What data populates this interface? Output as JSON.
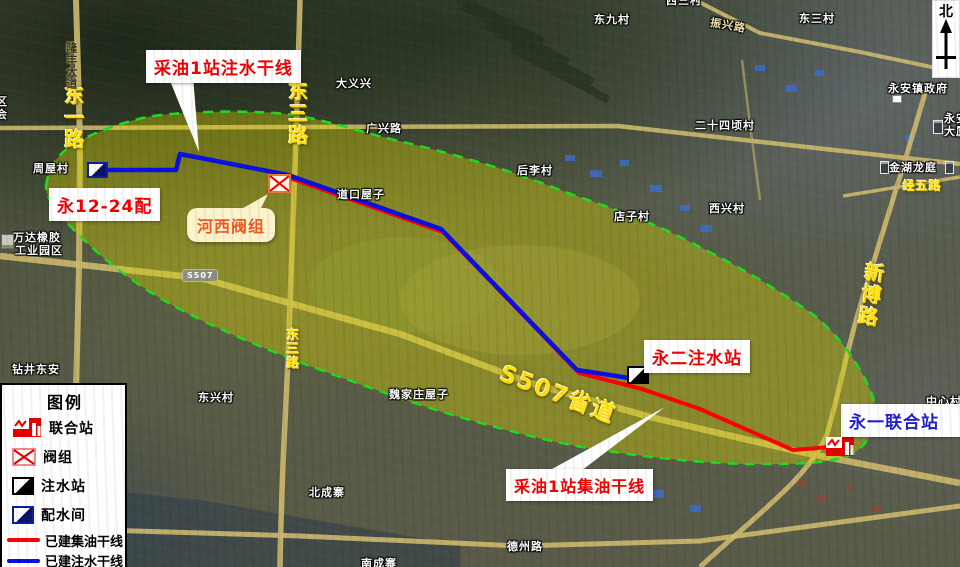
{
  "compass": {
    "north_label": "北"
  },
  "legend": {
    "title": "图例",
    "station_label": "联合站",
    "valve_label": "阀组",
    "injection_label": "注水站",
    "distribution_label": "配水间",
    "oil_line_label": "已建集油干线",
    "water_line_label": "已建注水干线"
  },
  "callouts": {
    "water_trunk": "采油1站注水干线",
    "oil_trunk": "采油1站集油干线",
    "valve_group": "河西阀组",
    "distribution_room": "永12-24配",
    "injection_station": "永二注水站",
    "union_station": "永一联合站"
  },
  "roads": {
    "dongyi": "东一路",
    "dongsan_upper": "东三路",
    "dongsan_lower": "东三路",
    "xinbo": "新博路",
    "s507_label": "S507省道",
    "s507_shield": "S507",
    "longfeng": "隆丰大道",
    "guangxing": "广兴路",
    "zhenxing": "振兴路",
    "jingwu": "经五路",
    "dezhou": "德州路"
  },
  "places": {
    "zhouwu": "周屋村",
    "wanda_line1": "万达橡胶",
    "wanda_line2": "工业园区",
    "zuanjing": "钻井东安",
    "dongxing": "东兴村",
    "dayixing": "大义兴",
    "dongjiu": "东九村",
    "dongsan_village": "东三村",
    "xisan_village": "西三村",
    "houli": "后李村",
    "ershisiqing": "二十四顷村",
    "xixing": "西兴村",
    "dianzi": "店子村",
    "daokou": "道口屋子",
    "weijiazhuang": "魏家庄屋子",
    "beicheng": "北成寨",
    "nancheng": "南成寨",
    "jinhu": "金湖龙庭",
    "yongan_gov": "永安镇政府",
    "yongan_bldg_line1": "永安",
    "yongan_bldg_line2": "大厦",
    "zhongxin": "中心村",
    "edge_qu": "区",
    "edge_hui": "会"
  },
  "colors": {
    "oil_line": "#ff0000",
    "water_line": "#0a10e0",
    "region_fill": "#d9d600",
    "region_border": "#1edc1e",
    "road": "#cdb96e"
  }
}
